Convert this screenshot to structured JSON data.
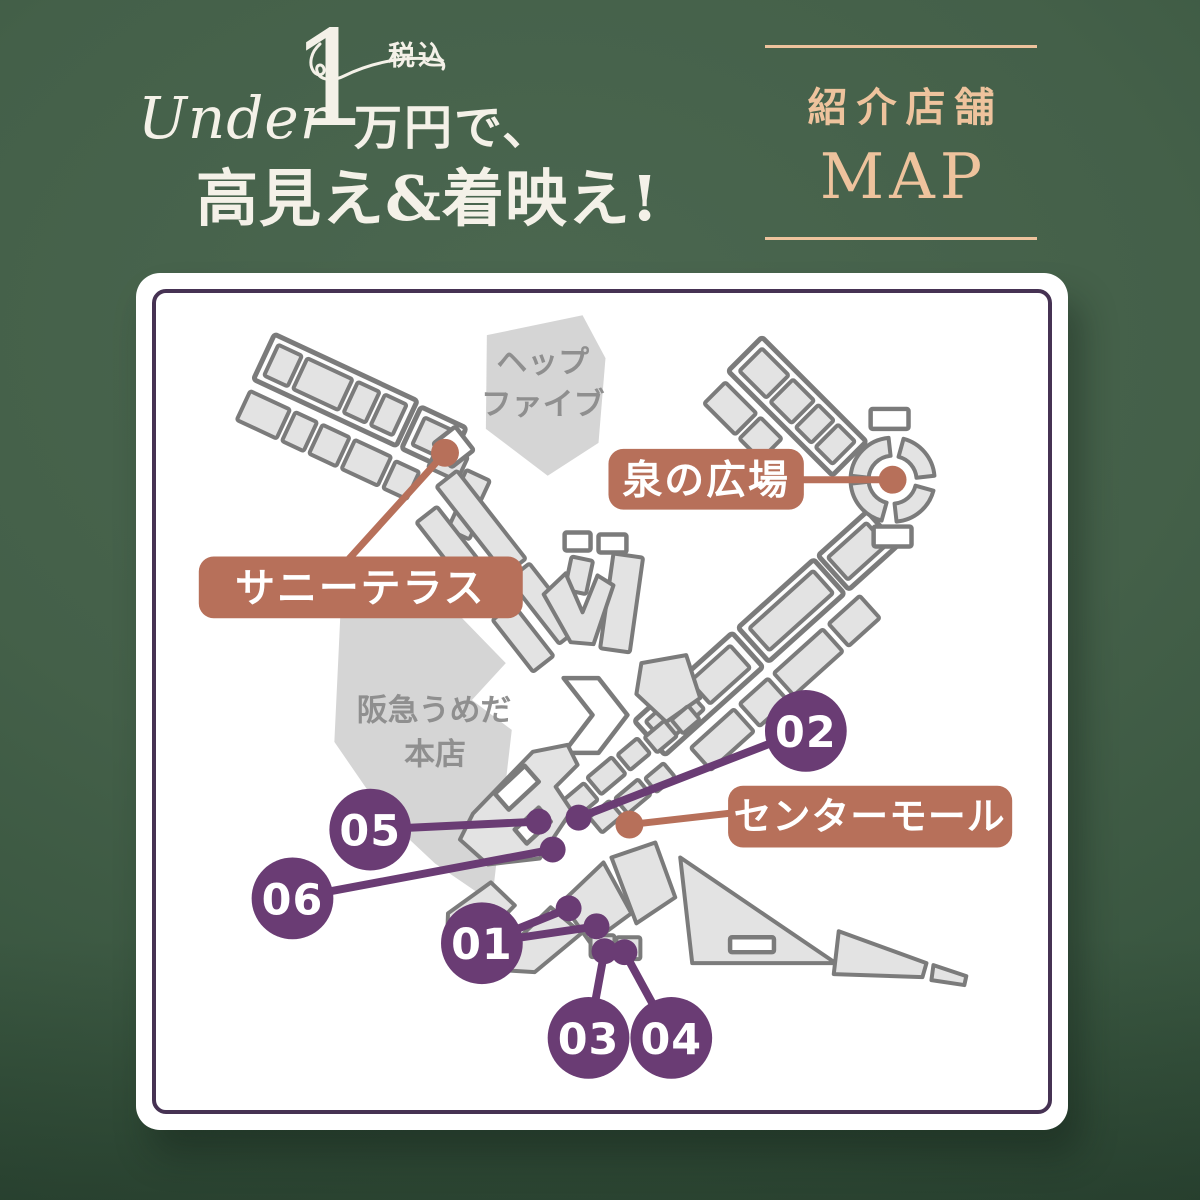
{
  "title": {
    "under": "Under",
    "big_one": "1",
    "man_yen": "万円で、",
    "tax_badge": "税込",
    "line2": "高見え&着映え!"
  },
  "intro_badge": {
    "line1": "紹介店舗",
    "line2": "MAP"
  },
  "map": {
    "blobs": {
      "hep_five": {
        "line1": "ヘップ",
        "line2": "ファイブ"
      },
      "hankyu": {
        "line1": "阪急うめだ",
        "line2": "本店"
      }
    },
    "labels": {
      "sunny_terrace": "サニーテラス",
      "izumi_plaza": "泉の広場",
      "center_mall": "センターモール"
    },
    "pins": [
      {
        "num": "01"
      },
      {
        "num": "02"
      },
      {
        "num": "03"
      },
      {
        "num": "04"
      },
      {
        "num": "05"
      },
      {
        "num": "06"
      }
    ]
  },
  "colors": {
    "background_green": "#44604a",
    "cream_text": "#f4f1e8",
    "peach_accent": "#eec39d",
    "terracotta_accent": "#b7705a",
    "purple_accent": "#6a3c74",
    "card_border_purple": "#463253",
    "map_gray_fill": "#e3e3e3",
    "map_gray_stroke": "#7b7b7b",
    "blob_gray": "#d5d5d5"
  }
}
